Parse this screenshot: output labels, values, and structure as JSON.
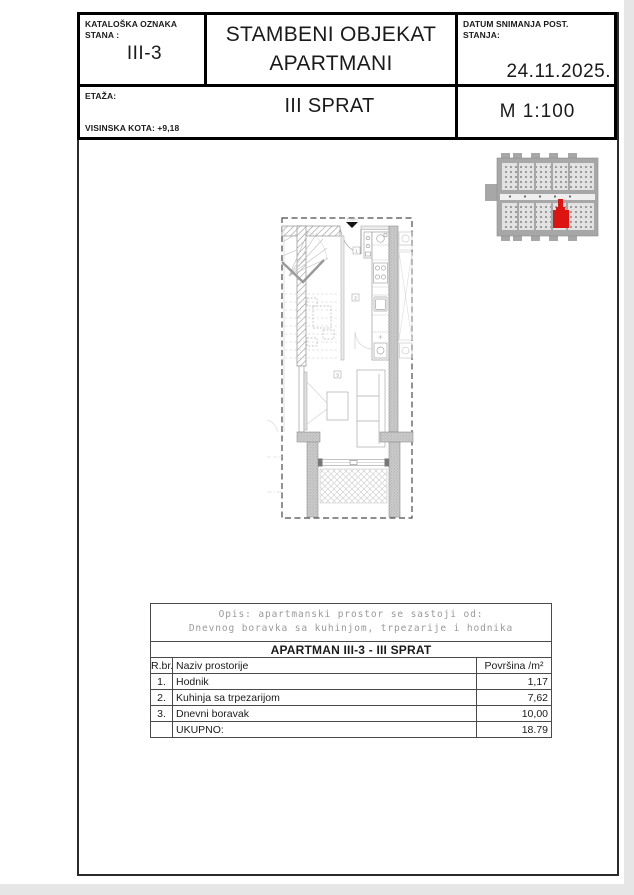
{
  "title_block": {
    "catalog_label_line1": "KATALOŠKA OZNAKA",
    "catalog_label_line2": "STANA :",
    "catalog_value": "III-3",
    "project_title_line1": "STAMBENI OBJEKAT",
    "project_title_line2": "APARTMANI",
    "date_label_line1": "DATUM SNIMANJA POST.",
    "date_label_line2": "STANJA:",
    "date_value": "24.11.2025.",
    "floor_label": "ETAŽA:",
    "floor_value": "III SPRAT",
    "elevation_label": "VISINSKA KOTA:  +9,18",
    "scale_value": "M  1:100"
  },
  "plan": {
    "entrance_label": "1.00m",
    "room_labels": [
      "1",
      "2",
      "3"
    ]
  },
  "key_plan": {
    "highlight_color": "#dc1412"
  },
  "table": {
    "opis_line1": "Opis:  apartmanski prostor se sastoji od:",
    "opis_line2": "Dnevnog boravka sa kuhinjom, trpezarije i hodnika",
    "title": "APARTMAN III-3 - III SPRAT",
    "headers": {
      "num": "R.br.",
      "name": "Naziv prostorije",
      "area": "Površina /m²"
    },
    "rows": [
      {
        "num": "1.",
        "name": "Hodnik",
        "area": "1,17"
      },
      {
        "num": "2.",
        "name": "Kuhinja sa trpezarijom",
        "area": "7,62"
      },
      {
        "num": "3.",
        "name": "Dnevni boravak",
        "area": "10,00"
      }
    ],
    "total_label": "UKUPNO:",
    "total_value": "18.79"
  }
}
